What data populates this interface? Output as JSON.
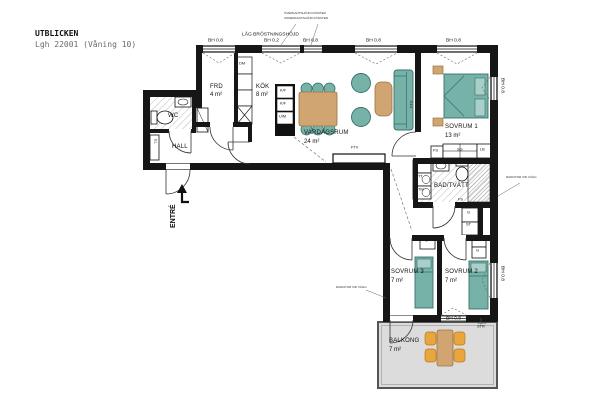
{
  "title": "UTBLICKEN",
  "subtitle": "Lgh 22001 (Våning 10)",
  "colors": {
    "wall": "#161616",
    "furniture_teal": "#76b2a8",
    "furniture_teal_dark": "#35726a",
    "furniture_teal_light": "#a9cfc8",
    "wood_tan": "#d1a572",
    "wood_tan_dark": "#9a7340",
    "chair_orange": "#e9a63f",
    "chair_orange_dark": "#b77a1e",
    "balcony_floor": "#dcdcdc",
    "line": "#333333",
    "text": "#111111"
  },
  "rooms": [
    {
      "name": "FRD",
      "area": "4 m²"
    },
    {
      "name": "KÖK",
      "area": "8 m²"
    },
    {
      "name": "VARDAGSRUM",
      "area": "24 m²"
    },
    {
      "name": "SOVRUM 1",
      "area": "13 m²"
    },
    {
      "name": "SOVRUM 2",
      "area": "7 m²"
    },
    {
      "name": "SOVRUM 3",
      "area": "7 m²"
    },
    {
      "name": "BAD/TVÄTT",
      "area": ""
    },
    {
      "name": "WC",
      "area": ""
    },
    {
      "name": "HALL",
      "area": ""
    },
    {
      "name": "BALKONG",
      "area": "7 m²"
    }
  ],
  "labels": [
    {
      "id": "bh-w1",
      "t": "BH 0.8",
      "x": 208,
      "y": 38,
      "c": "bh"
    },
    {
      "id": "lag-brostningshojd",
      "t": "LÅG BRÖSTNINGSHÖJD",
      "x": 242,
      "y": 32,
      "c": "bh"
    },
    {
      "id": "bh-w2",
      "t": "BH 0.2",
      "x": 264,
      "y": 38,
      "c": "bh"
    },
    {
      "id": "bh-w3",
      "t": "BH 0.8",
      "x": 303,
      "y": 38,
      "c": "bh"
    },
    {
      "id": "bh-w4",
      "t": "BH 0.8",
      "x": 366,
      "y": 38,
      "c": "bh"
    },
    {
      "id": "bh-w5",
      "t": "BH 0.8",
      "x": 446,
      "y": 38,
      "c": "bh"
    },
    {
      "id": "ann-top-1",
      "t": "ÖVERKANTSHÖJD FÖNSTER",
      "x": 284,
      "y": 12,
      "c": "tiny"
    },
    {
      "id": "ann-top-2",
      "t": "UNDERKANTSHÖJD FÖNSTER",
      "x": 284,
      "y": 17,
      "c": "tiny"
    },
    {
      "id": "bh-w6",
      "t": "BH 0.8",
      "x": 505,
      "y": 78,
      "c": "bh v90"
    },
    {
      "id": "bh-w7",
      "t": "BH 0.8",
      "x": 505,
      "y": 266,
      "c": "bh v90"
    },
    {
      "id": "bh-w8",
      "t": "BH 0.8",
      "x": 446,
      "y": 316,
      "c": "bh"
    },
    {
      "id": "str",
      "t": "STR",
      "x": 477,
      "y": 325,
      "c": "fix"
    },
    {
      "id": "frd",
      "t": "FRD",
      "x": 210,
      "y": 84,
      "c": "room"
    },
    {
      "id": "frd-area",
      "t": "4 m²",
      "x": 210,
      "y": 92,
      "c": "area"
    },
    {
      "id": "kok",
      "t": "KÖK",
      "x": 256,
      "y": 84,
      "c": "room"
    },
    {
      "id": "kok-area",
      "t": "8 m²",
      "x": 256,
      "y": 92,
      "c": "area"
    },
    {
      "id": "dm",
      "t": "DM",
      "x": 239,
      "y": 62,
      "c": "fix"
    },
    {
      "id": "kf1",
      "t": "K/F",
      "x": 280,
      "y": 89,
      "c": "fix"
    },
    {
      "id": "kf2",
      "t": "K/F",
      "x": 280,
      "y": 102,
      "c": "fix"
    },
    {
      "id": "um",
      "t": "U/M",
      "x": 279,
      "y": 115,
      "c": "fix"
    },
    {
      "id": "vardagsrum",
      "t": "VARDAGSRUM",
      "x": 304,
      "y": 130,
      "c": "room"
    },
    {
      "id": "vardagsrum-area",
      "t": "24 m²",
      "x": 304,
      "y": 139,
      "c": "area"
    },
    {
      "id": "ftv-vardagsrum",
      "t": "FTV",
      "x": 351,
      "y": 146,
      "c": "fix"
    },
    {
      "id": "ftv-wall-left",
      "t": "FTV",
      "x": 410,
      "y": 108,
      "c": "fix v270"
    },
    {
      "id": "ftv-wall-right",
      "t": "FTV",
      "x": 417,
      "y": 108,
      "c": "fix v270"
    },
    {
      "id": "sovrum1",
      "t": "SOVRUM 1",
      "x": 445,
      "y": 124,
      "c": "room"
    },
    {
      "id": "sovrum1-area",
      "t": "13 m²",
      "x": 445,
      "y": 133,
      "c": "area"
    },
    {
      "id": "fs-sovrum1",
      "t": "FS",
      "x": 433,
      "y": 149,
      "c": "fix"
    },
    {
      "id": "sg",
      "t": "SG",
      "x": 457,
      "y": 148,
      "c": "fix"
    },
    {
      "id": "lb",
      "t": "LB",
      "x": 480,
      "y": 148,
      "c": "fix"
    },
    {
      "id": "wc",
      "t": "WC",
      "x": 168,
      "y": 113,
      "c": "room"
    },
    {
      "id": "hall",
      "t": "HALL",
      "x": 172,
      "y": 144,
      "c": "room"
    },
    {
      "id": "el",
      "t": "EL",
      "x": 157,
      "y": 139,
      "c": "fix v90"
    },
    {
      "id": "entre",
      "t": "ENTRÉ",
      "x": 170,
      "y": 228,
      "c": "entre v270"
    },
    {
      "id": "bad-tvatt",
      "t": "BAD/TVÄTT",
      "x": 434,
      "y": 183,
      "c": "room"
    },
    {
      "id": "tt",
      "t": "TT",
      "x": 418,
      "y": 175,
      "c": "fix"
    },
    {
      "id": "tm",
      "t": "TM",
      "x": 418,
      "y": 188,
      "c": "fix"
    },
    {
      "id": "fs-bad-1",
      "t": "FS",
      "x": 420,
      "y": 203,
      "c": "fix"
    },
    {
      "id": "fs-bad-2",
      "t": "FS",
      "x": 458,
      "y": 198,
      "c": "fix"
    },
    {
      "id": "g-korridor",
      "t": "G",
      "x": 467,
      "y": 211,
      "c": "fix"
    },
    {
      "id": "st",
      "t": "ST",
      "x": 466,
      "y": 223,
      "c": "fix"
    },
    {
      "id": "g-sovrum3",
      "t": "G",
      "x": 425,
      "y": 239,
      "c": "fix"
    },
    {
      "id": "g-sovrum2-1",
      "t": "G",
      "x": 476,
      "y": 238,
      "c": "fix"
    },
    {
      "id": "g-sovrum2-2",
      "t": "G",
      "x": 476,
      "y": 249,
      "c": "fix"
    },
    {
      "id": "sovrum3",
      "t": "SOVRUM 3",
      "x": 391,
      "y": 269,
      "c": "room"
    },
    {
      "id": "sovrum3-area",
      "t": "7 m²",
      "x": 391,
      "y": 278,
      "c": "area"
    },
    {
      "id": "sovrum2",
      "t": "SOVRUM 2",
      "x": 445,
      "y": 269,
      "c": "room"
    },
    {
      "id": "sovrum2-area",
      "t": "7 m²",
      "x": 445,
      "y": 278,
      "c": "area"
    },
    {
      "id": "radiator-hoger",
      "t": "RADIATOR VID VÄGG",
      "x": 506,
      "y": 176,
      "c": "tiny"
    },
    {
      "id": "radiator-vanster",
      "t": "RADIATOR VID VÄGG",
      "x": 336,
      "y": 286,
      "c": "tiny"
    },
    {
      "id": "balkong",
      "t": "BALKONG",
      "x": 389,
      "y": 338,
      "c": "room"
    },
    {
      "id": "balkong-area",
      "t": "7 m²",
      "x": 389,
      "y": 347,
      "c": "area"
    }
  ]
}
